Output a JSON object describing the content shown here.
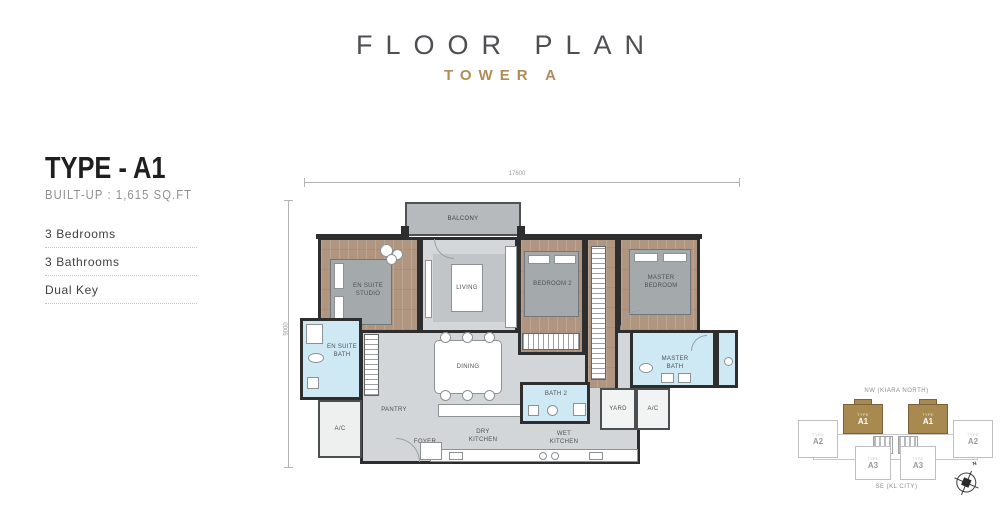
{
  "header": {
    "title": "FLOOR PLAN",
    "subtitle": "TOWER A"
  },
  "unit_info": {
    "type_label": "TYPE - A1",
    "built_up": "BUILT-UP : 1,615 SQ.FT",
    "features": [
      "3 Bedrooms",
      "3 Bathrooms",
      "Dual Key"
    ]
  },
  "plan": {
    "dim_width": "17600",
    "dim_depth": "9000",
    "rooms": {
      "balcony": "BALCONY",
      "en_suite_studio": "EN SUITE STUDIO",
      "living": "LIVING",
      "dining": "DINING",
      "bedroom2": "BEDROOM 2",
      "master_bedroom": "MASTER BEDROOM",
      "en_suite_bath": "EN SUITE BATH",
      "pantry": "PANTRY",
      "foyer": "FOYER",
      "dry_kitchen": "DRY KITCHEN",
      "wet_kitchen": "WET KITCHEN",
      "bath2": "BATH 2",
      "master_bath": "MASTER BATH",
      "yard": "YARD",
      "ac": "A/C"
    }
  },
  "keyplan": {
    "north_label": "NW (KIARA NORTH)",
    "south_label": "SE (KL CITY)",
    "compass_label": "N",
    "units": [
      {
        "label": "A1",
        "tag": "TYPE",
        "highlighted": true
      },
      {
        "label": "A1",
        "tag": "TYPE",
        "highlighted": true
      },
      {
        "label": "A2",
        "tag": "TYPE",
        "highlighted": false
      },
      {
        "label": "A2",
        "tag": "TYPE",
        "highlighted": false
      },
      {
        "label": "A3",
        "tag": "TYPE",
        "highlighted": false
      },
      {
        "label": "A3",
        "tag": "TYPE",
        "highlighted": false
      }
    ]
  },
  "colors": {
    "accent_gold": "#b08d57",
    "wall": "#2e2e2e",
    "wood_floor": "#b09681",
    "tile_gray": "#d3d6d8",
    "bath_blue": "#cfe9f4"
  }
}
